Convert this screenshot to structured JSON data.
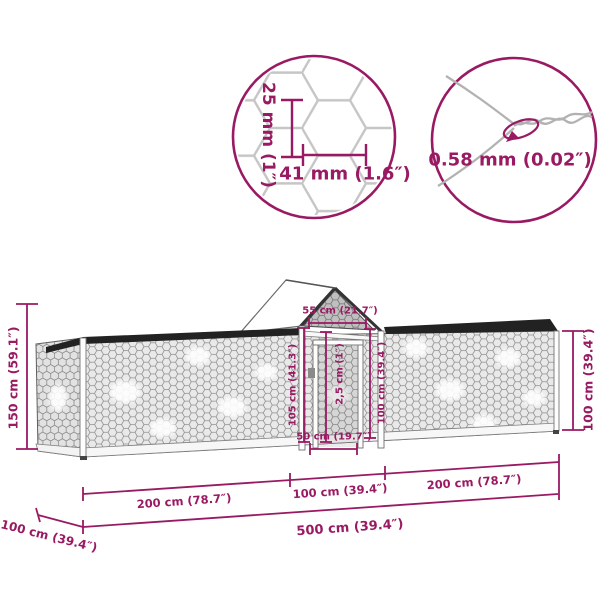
{
  "colors": {
    "accent": "#991a63",
    "mesh_line": "#8e8e8e",
    "mesh_bg": "#e9e9e9",
    "rail_dark": "#222222",
    "background": "#ffffff"
  },
  "callout_mesh": {
    "cell_height": "25 mm (1″)",
    "cell_width": "41 mm (1.6″)"
  },
  "callout_wire": {
    "wire_diameter": "0.58 mm (0.02″)"
  },
  "dimensions": {
    "overall_height": "150 cm (59.1″)",
    "run_height_right": "100 cm (39.4″)",
    "coop_top_width": "55 cm (21.7″)",
    "coop_left_height": "105 cm (41.3″)",
    "frame_thickness": "2,5 cm (1″)",
    "coop_right_height": "100 cm (39.4″)",
    "door_width": "50 cm (19.7″)",
    "left_run_length": "200 cm (78.7″)",
    "middle_length": "100 cm (39.4″)",
    "right_run_length": "200 cm (78.7″)",
    "total_length": "500 cm (39.4″)",
    "depth": "100 cm (39.4″)"
  }
}
